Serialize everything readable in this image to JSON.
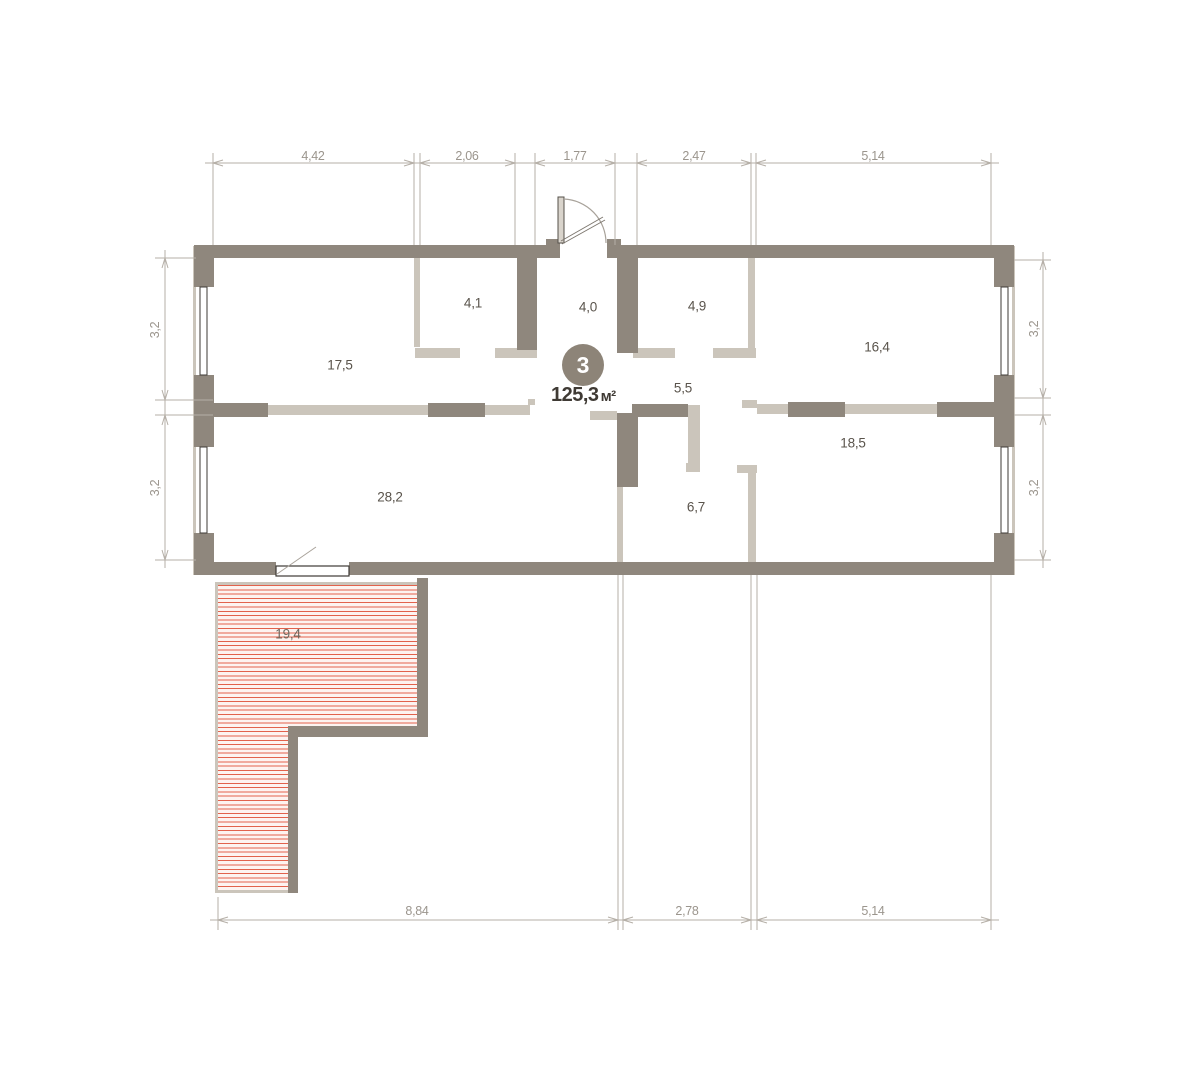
{
  "plan": {
    "unit": {
      "number": "3",
      "total_area": "125,3",
      "area_unit": "м²"
    },
    "rooms": [
      {
        "area": "17,5"
      },
      {
        "area": "4,1"
      },
      {
        "area": "4,0"
      },
      {
        "area": "4,9"
      },
      {
        "area": "16,4"
      },
      {
        "area": "5,5"
      },
      {
        "area": "18,5"
      },
      {
        "area": "28,2"
      },
      {
        "area": "6,7"
      },
      {
        "area": "19,4"
      }
    ],
    "dims": {
      "top": [
        "4,42",
        "2,06",
        "1,77",
        "2,47",
        "5,14"
      ],
      "bottom": [
        "8,84",
        "2,78",
        "5,14"
      ],
      "left": [
        "3,2",
        "3,2"
      ],
      "right": [
        "3,2",
        "3,2"
      ]
    },
    "colors": {
      "wall": "#8f877d",
      "partition": "#cbc5bb",
      "window_frame": "#3e3a35",
      "hatch_line": "#e2624c",
      "hatch_bg": "#fdf3f0",
      "dim_line": "#b5afa7",
      "dim_text": "#9b958d",
      "room_text": "#5a544c",
      "badge_bg": "#8d8478",
      "total_text": "#3f3a34"
    }
  }
}
